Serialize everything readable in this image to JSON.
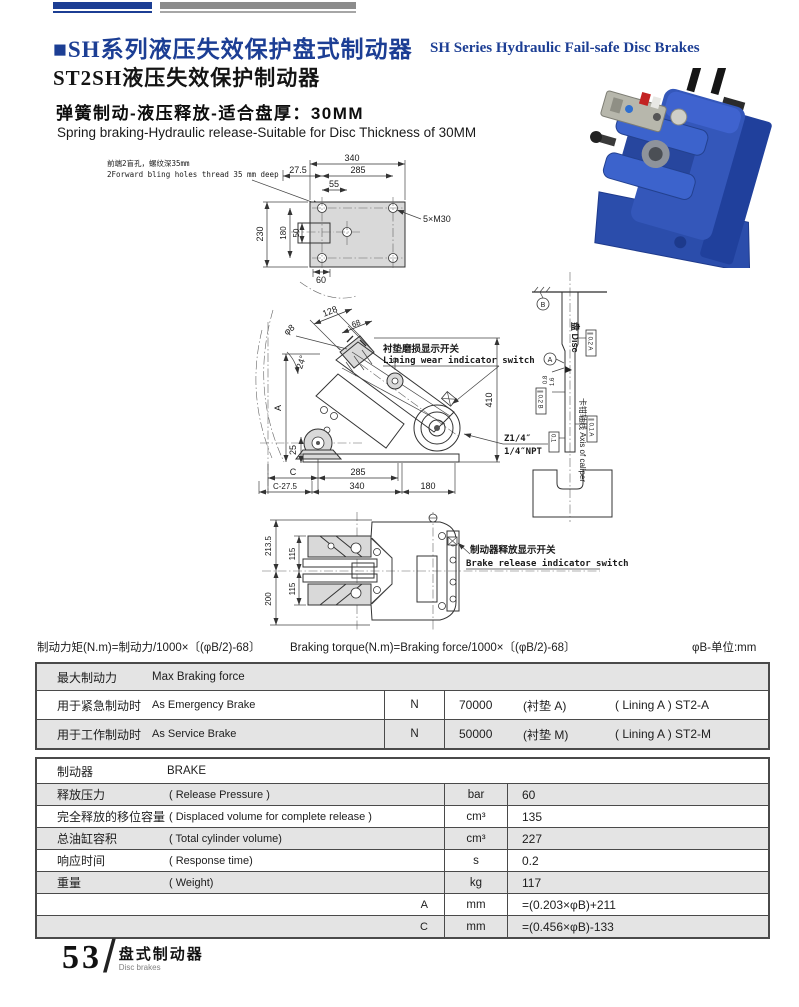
{
  "header": {
    "title_cn": "■SH系列液压失效保护盘式制动器",
    "title_en": "SH Series Hydraulic Fail-safe Disc Brakes",
    "model_title": "ST2SH液压失效保护制动器",
    "feature_cn": "弹簧制动-液压释放-适合盘厚：30MM",
    "feature_en": "Spring braking-Hydraulic release-Suitable for Disc Thickness of 30MM"
  },
  "colors": {
    "accent_blue": "#1c3e94",
    "bar_gray": "#8c8c8c",
    "row_shade": "#e4e4e4"
  },
  "drawings": {
    "top_view": {
      "note_cn": "前端2盲孔，螺纹深35mm",
      "note_en": "2Forward bling holes thread 35 mm deep",
      "dim_340": "340",
      "dim_27_5": "27.5",
      "dim_285": "285",
      "dim_55": "55",
      "thread_label": "5×M30",
      "dim_230": "230",
      "dim_180": "180",
      "dim_50": "50",
      "dim_60": "60"
    },
    "side_view": {
      "dim_hole": "φ8",
      "dim_128": "128",
      "dim_68": "68",
      "dim_angle": "24°",
      "switch_cn": "衬垫磨损显示开关",
      "switch_en": "Lining wear indicator switch",
      "dim_410": "410",
      "port_1": "Z1/4″",
      "port_2": "1/4″NPT",
      "dim_A": "A",
      "dim_25": "25",
      "dim_C": "C",
      "dim_285": "285",
      "dim_C27": "C-27.5",
      "dim_340": "340",
      "dim_180": "180"
    },
    "disc_view": {
      "datum_b": "B",
      "datum_a": "A",
      "disc_label": "盘 Disc",
      "rough_1": "0.8",
      "rough_2": "1.6",
      "tol_1": "∥ 0.2 A",
      "tol_2": "∥ 0.2 B",
      "tol_3": "∥ 0.1 A",
      "tol_4": "0.1",
      "axis_label": "卡钳轴线 Axis of caliper"
    },
    "bottom_view": {
      "dim_2135": "213.5",
      "dim_115_top": "115",
      "dim_115_bot": "115",
      "dim_200": "200",
      "switch_cn": "制动器释放显示开关",
      "switch_en": "Brake release indicator switch"
    }
  },
  "formula": {
    "cn": "制动力矩(N.m)=制动力/1000×〔(φB/2)-68〕",
    "en": "Braking torque(N.m)=Braking force/1000×〔(φB/2)-68〕",
    "unit_note": "φB-单位:mm"
  },
  "table_braking_force": {
    "header_cn": "最大制动力",
    "header_en": "Max Braking force",
    "rows": [
      {
        "cn": "用于紧急制动时",
        "en": "As Emergency Brake",
        "unit": "N",
        "value": "70000",
        "lining_cn": "(衬垫 A)",
        "lining_en": "( Lining A ) ST2-A"
      },
      {
        "cn": "用于工作制动时",
        "en": "As Service Brake",
        "unit": "N",
        "value": "50000",
        "lining_cn": "(衬垫 M)",
        "lining_en": "( Lining A ) ST2-M"
      }
    ]
  },
  "table_brake_specs": {
    "header_cn": "制动器",
    "header_en": "BRAKE",
    "rows": [
      {
        "cn": "释放压力",
        "en": "( Release Pressure )",
        "label": "",
        "unit": "bar",
        "value": "60"
      },
      {
        "cn": "完全释放的移位容量",
        "en": "( Displaced volume for complete release )",
        "label": "",
        "unit": "cm³",
        "value": "135"
      },
      {
        "cn": "总油缸容积",
        "en": "( Total cylinder volume)",
        "label": "",
        "unit": "cm³",
        "value": "227"
      },
      {
        "cn": "响应时间",
        "en": "( Response time)",
        "label": "",
        "unit": "s",
        "value": "0.2"
      },
      {
        "cn": "重量",
        "en": "( Weight)",
        "label": "",
        "unit": "kg",
        "value": "117"
      },
      {
        "cn": "",
        "en": "",
        "label": "A",
        "unit": "mm",
        "value": "=(0.203×φB)+211"
      },
      {
        "cn": "",
        "en": "",
        "label": "C",
        "unit": "mm",
        "value": "=(0.456×φB)-133"
      }
    ]
  },
  "footer": {
    "page_number": "53",
    "slash": "/",
    "section_cn": "盘式制动器",
    "section_en": "Disc brakes"
  }
}
